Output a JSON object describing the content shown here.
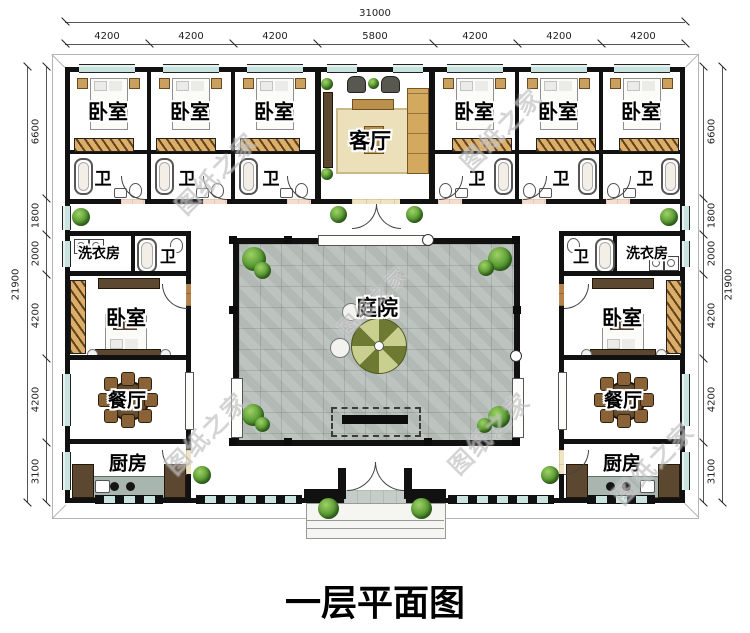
{
  "title": "一层平面图",
  "watermark": "图纸之家",
  "dimensions": {
    "top": {
      "total": "31000",
      "segments": [
        "4200",
        "4200",
        "4200",
        "5800",
        "4200",
        "4200",
        "4200"
      ]
    },
    "left": {
      "total": "21900",
      "segments": [
        "6600",
        "1800",
        "2000",
        "4200",
        "4200",
        "3100"
      ]
    },
    "right": {
      "total": "21900",
      "segments": [
        "6600",
        "1800",
        "2000",
        "4200",
        "4200",
        "3100"
      ]
    }
  },
  "labels": {
    "bedroom": "卧室",
    "bath": "卫",
    "living": "客厅",
    "laundry": "洗衣房",
    "dining": "餐厅",
    "kitchen": "厨房",
    "courtyard": "庭院"
  },
  "colors": {
    "wall": "#111111",
    "wood_floor": "#b5824c",
    "tile_floor": "#f1e4c2",
    "bath_floor": "#f4ddcf",
    "paving": "#c6cdc9",
    "courtyard_paving": "#b9c0bc",
    "window": "#c9e3df",
    "plant": "#55a033"
  }
}
